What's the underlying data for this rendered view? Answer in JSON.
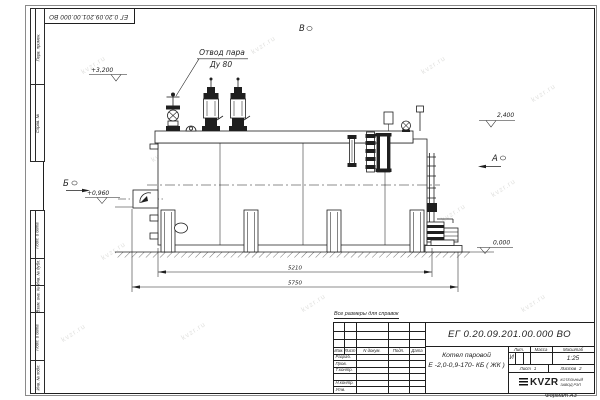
{
  "colors": {
    "line": "#1f1f1f",
    "paper": "#ffffff",
    "watermark": "#e2e2e0"
  },
  "sheet": {
    "watermark": "kvzr.ru",
    "format_label": "Формат  А3",
    "side_labels": {
      "perv": "Перв. примен.",
      "sprav": "Справ. №",
      "podp1": "Подп. и дата",
      "inv_dubl": "Инв. № дубл.",
      "vzam": "Взам. инв. №",
      "podp2": "Подп. и дата",
      "inv_podl": "Инв. № подл."
    }
  },
  "drawing": {
    "callout_line1": "Отвод пара",
    "callout_line2": "Ду 80",
    "level_3200": "+3,200",
    "level_2400": "2,400",
    "level_0960": "+0,960",
    "level_0000": "0,000",
    "view_a": "А",
    "view_b": "Б",
    "view_v": "В",
    "dim_inner": "5210",
    "dim_outer": "5750"
  },
  "titleblock": {
    "note": "Все размеры для справок",
    "doc_number": "ЕГ 0.20.09.201.00.000  ВО",
    "product_line1": "Котел паровой",
    "product_line2": "Е -2,0-0,9-170- КБ ( ЖК )",
    "headers": {
      "izm": "Изм.",
      "list": "Лист",
      "ndoc": "N докум.",
      "podp": "Подп.",
      "data": "Дата",
      "lit": "Лит.",
      "massa": "Масса",
      "scale": "Масштаб"
    },
    "rows": {
      "razrab": "Разраб.",
      "prov": "Пров.",
      "tkontr": "Т.контр.",
      "nkontr": "Н.контр.",
      "utv": "Утв."
    },
    "lit_value": "И",
    "scale_value": "1:25",
    "sheet_label": "Лист",
    "sheet_num": "1",
    "sheets_label": "Листов",
    "sheets_num": "2",
    "logo_text": "KVZR",
    "logo_sub1": "КОТЕЛЬНЫЙ",
    "logo_sub2": "ЗАВОД РЭП"
  }
}
